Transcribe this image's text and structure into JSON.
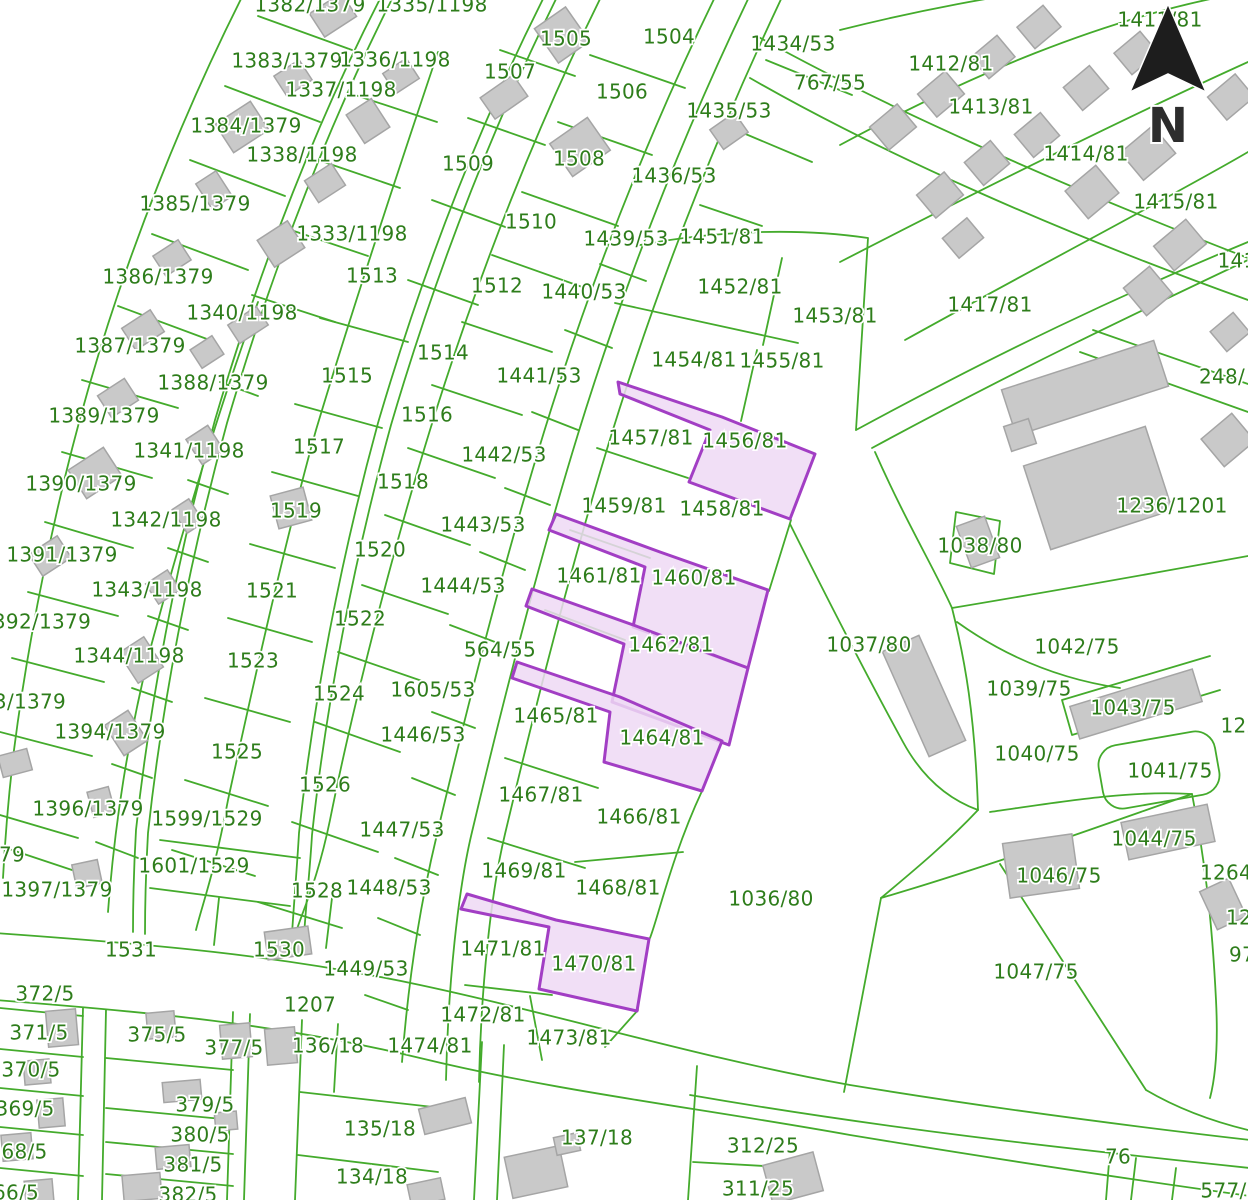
{
  "map": {
    "type": "cadastral-parcel-map",
    "colors": {
      "background": "#ffffff",
      "line": "#44ab2c",
      "label": "#2e7d1b",
      "building_fill": "#c9c9c9",
      "building_stroke": "#a5a5a5",
      "highlight_fill": "#eed9f5",
      "highlight_stroke": "#a23ec4",
      "north_arrow": "#1d1d1d"
    },
    "north": {
      "letter": "N"
    },
    "highlighted_parcels": [
      "1456/81",
      "1460/81",
      "1462/81",
      "1464/81",
      "1470/81"
    ],
    "labels": [
      [
        "1382/1379",
        310,
        6
      ],
      [
        "1335/1198",
        432,
        6
      ],
      [
        "1411/81",
        1160,
        21
      ],
      [
        "1505",
        566,
        40
      ],
      [
        "1504",
        669,
        38
      ],
      [
        "1434/53",
        793,
        45
      ],
      [
        "1383/1379",
        287,
        62
      ],
      [
        "1336/1198",
        395,
        61
      ],
      [
        "1412/81",
        951,
        65
      ],
      [
        "1507",
        510,
        73
      ],
      [
        "767/55",
        830,
        84
      ],
      [
        "1506",
        622,
        93
      ],
      [
        "1337/1198",
        341,
        91
      ],
      [
        "1435/53",
        729,
        112
      ],
      [
        "1413/81",
        991,
        108
      ],
      [
        "1384/1379",
        246,
        127
      ],
      [
        "1338/1198",
        302,
        156
      ],
      [
        "1508",
        579,
        160
      ],
      [
        "1509",
        468,
        165
      ],
      [
        "1414/81",
        1086,
        155
      ],
      [
        "1436/53",
        674,
        177
      ],
      [
        "1385/1379",
        195,
        205
      ],
      [
        "1415/81",
        1176,
        203
      ],
      [
        "1510",
        531,
        223
      ],
      [
        "1333/1198",
        352,
        235
      ],
      [
        "1439/53",
        626,
        240
      ],
      [
        "1451/81",
        722,
        238
      ],
      [
        "141",
        1237,
        262
      ],
      [
        "1386/1379",
        158,
        278
      ],
      [
        "1513",
        372,
        277
      ],
      [
        "1512",
        497,
        287
      ],
      [
        "1440/53",
        584,
        293
      ],
      [
        "1452/81",
        740,
        288
      ],
      [
        "1417/81",
        990,
        306
      ],
      [
        "1340/1198",
        242,
        314
      ],
      [
        "1453/81",
        835,
        317
      ],
      [
        "1387/1379",
        130,
        347
      ],
      [
        "1514",
        443,
        354
      ],
      [
        "1515",
        347,
        377
      ],
      [
        "1388/1379",
        213,
        384
      ],
      [
        "1441/53",
        539,
        377
      ],
      [
        "1454/81",
        694,
        361
      ],
      [
        "1455/81",
        782,
        362
      ],
      [
        "248/",
        1222,
        378
      ],
      [
        "1389/1379",
        104,
        417
      ],
      [
        "1516",
        427,
        416
      ],
      [
        "1457/81",
        651,
        439
      ],
      [
        "1456/81",
        745,
        442
      ],
      [
        "1341/1198",
        189,
        452
      ],
      [
        "1517",
        319,
        448
      ],
      [
        "1442/53",
        504,
        456
      ],
      [
        "1236/1201",
        1172,
        507
      ],
      [
        "1390/1379",
        81,
        485
      ],
      [
        "1518",
        403,
        483
      ],
      [
        "1519",
        296,
        512
      ],
      [
        "1459/81",
        624,
        507
      ],
      [
        "1458/81",
        722,
        510
      ],
      [
        "1038/80",
        980,
        547
      ],
      [
        "1342/1198",
        166,
        521
      ],
      [
        "1443/53",
        483,
        526
      ],
      [
        "1520",
        380,
        551
      ],
      [
        "1391/1379",
        62,
        556
      ],
      [
        "1461/81",
        599,
        577
      ],
      [
        "1460/81",
        694,
        579
      ],
      [
        "1343/1198",
        147,
        591
      ],
      [
        "1521",
        272,
        592
      ],
      [
        "1444/53",
        463,
        587
      ],
      [
        "1522",
        360,
        620
      ],
      [
        "392/1379",
        42,
        623
      ],
      [
        "564/55",
        500,
        651
      ],
      [
        "1462/81",
        671,
        646
      ],
      [
        "1037/80",
        869,
        646
      ],
      [
        "1042/75",
        1077,
        648
      ],
      [
        "1344/1198",
        129,
        657
      ],
      [
        "1523",
        253,
        662
      ],
      [
        "1039/75",
        1029,
        690
      ],
      [
        "1605/53",
        433,
        691
      ],
      [
        "1524",
        339,
        695
      ],
      [
        "3/1379",
        30,
        703
      ],
      [
        "1043/75",
        1133,
        709
      ],
      [
        "1394/1379",
        110,
        733
      ],
      [
        "122",
        1240,
        727
      ],
      [
        "1525",
        237,
        753
      ],
      [
        "1446/53",
        423,
        736
      ],
      [
        "1465/81",
        556,
        717
      ],
      [
        "1464/81",
        662,
        739
      ],
      [
        "1040/75",
        1037,
        755
      ],
      [
        "1041/75",
        1170,
        772
      ],
      [
        "1526",
        325,
        786
      ],
      [
        "1396/1379",
        88,
        810
      ],
      [
        "1599/1529",
        207,
        820
      ],
      [
        "1467/81",
        541,
        796
      ],
      [
        "1466/81",
        639,
        818
      ],
      [
        "1036/80",
        771,
        900
      ],
      [
        "1044/75",
        1154,
        840
      ],
      [
        "79",
        12,
        856
      ],
      [
        "1601/1529",
        194,
        867
      ],
      [
        "1447/53",
        402,
        831
      ],
      [
        "1469/81",
        524,
        872
      ],
      [
        "1468/81",
        618,
        889
      ],
      [
        "1397/1379",
        57,
        891
      ],
      [
        "1528",
        317,
        892
      ],
      [
        "1448/53",
        389,
        889
      ],
      [
        "1046/75",
        1059,
        877
      ],
      [
        "1264",
        1226,
        874
      ],
      [
        "12",
        1239,
        919
      ],
      [
        "1531",
        131,
        951
      ],
      [
        "1530",
        279,
        951
      ],
      [
        "1449/53",
        366,
        970
      ],
      [
        "97",
        1242,
        956
      ],
      [
        "372/5",
        45,
        995
      ],
      [
        "1471/81",
        503,
        950
      ],
      [
        "1470/81",
        594,
        965
      ],
      [
        "371/5",
        39,
        1034
      ],
      [
        "375/5",
        157,
        1036
      ],
      [
        "377/5",
        234,
        1049
      ],
      [
        "1207",
        310,
        1006
      ],
      [
        "136/18",
        328,
        1047
      ],
      [
        "1474/81",
        430,
        1047
      ],
      [
        "1472/81",
        483,
        1016
      ],
      [
        "1473/81",
        569,
        1039
      ],
      [
        "1047/75",
        1036,
        973
      ],
      [
        "370/5",
        31,
        1071
      ],
      [
        "369/5",
        25,
        1110
      ],
      [
        "368/5",
        18,
        1153
      ],
      [
        "66/5",
        16,
        1194
      ],
      [
        "379/5",
        205,
        1106
      ],
      [
        "380/5",
        200,
        1136
      ],
      [
        "381/5",
        193,
        1166
      ],
      [
        "382/5",
        188,
        1196
      ],
      [
        "135/18",
        380,
        1130
      ],
      [
        "134/18",
        372,
        1178
      ],
      [
        "137/18",
        597,
        1139
      ],
      [
        "312/25",
        763,
        1147
      ],
      [
        "311/25",
        758,
        1190
      ],
      [
        "76",
        1118,
        1158
      ],
      [
        "577/5",
        1230,
        1192
      ]
    ]
  }
}
